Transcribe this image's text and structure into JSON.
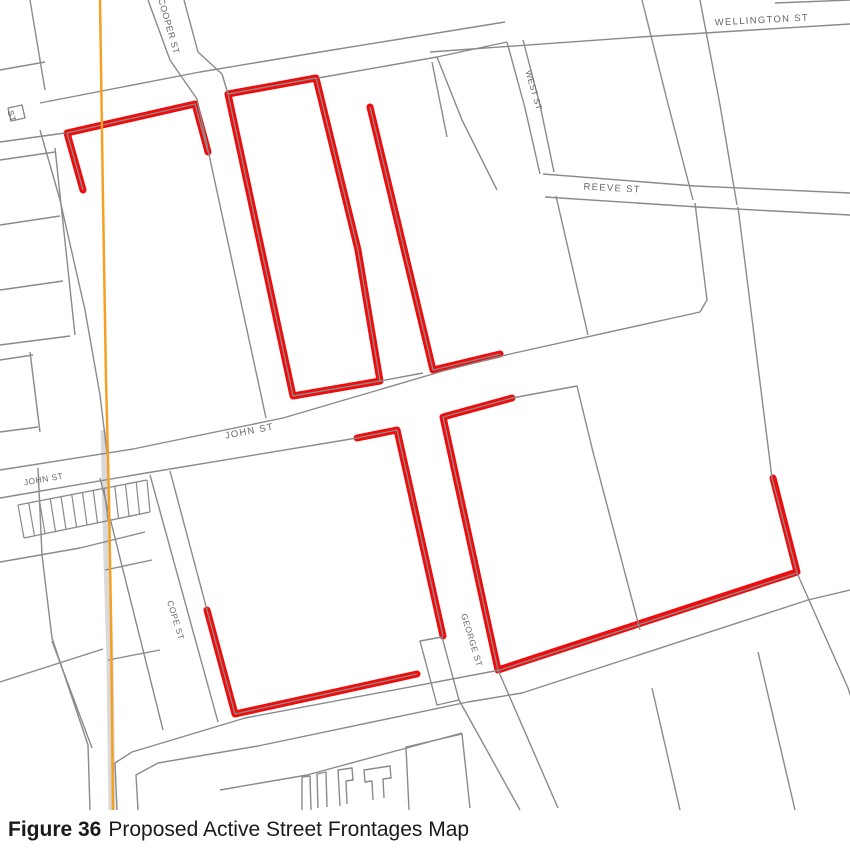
{
  "figure": {
    "label": "Figure 36",
    "title": "Proposed Active Street Frontages Map"
  },
  "map": {
    "colors": {
      "frontage": "#f00c0c",
      "road": "#8a8a8a",
      "rail": "#f5a023",
      "rail_band": "#d9d9d9",
      "label": "#666666"
    },
    "street_labels": [
      {
        "text": "COOPER ST",
        "x": 166,
        "y": 27,
        "angle": 74,
        "size": 9,
        "spacing": 0.5
      },
      {
        "text": "ST",
        "x": 9,
        "y": 117,
        "angle": 74,
        "size": 8.5,
        "spacing": 0.5
      },
      {
        "text": "WELLINGTON ST",
        "x": 762,
        "y": 23,
        "angle": -3,
        "size": 9.5,
        "spacing": 1.3
      },
      {
        "text": "WEST ST",
        "x": 531,
        "y": 91,
        "angle": 74,
        "size": 8.5,
        "spacing": 0.5
      },
      {
        "text": "REEVE ST",
        "x": 612,
        "y": 191,
        "angle": 3,
        "size": 9.5,
        "spacing": 1.3
      },
      {
        "text": "JOHN ST",
        "x": 250,
        "y": 434,
        "angle": -11,
        "size": 9.5,
        "spacing": 1.3
      },
      {
        "text": "JOHN ST",
        "x": 44,
        "y": 482,
        "angle": -10,
        "size": 8.5,
        "spacing": 0.5
      },
      {
        "text": "COPE ST",
        "x": 173,
        "y": 621,
        "angle": 73,
        "size": 8.5,
        "spacing": 0.5
      },
      {
        "text": "GEORGE ST",
        "x": 469,
        "y": 641,
        "angle": 73,
        "size": 8.5,
        "spacing": 0.5
      }
    ],
    "frontages": [
      {
        "pts": [
          [
            83,
            190
          ],
          [
            67,
            133
          ],
          [
            195,
            104
          ],
          [
            208,
            152
          ]
        ]
      },
      {
        "pts": [
          [
            228,
            94
          ],
          [
            316,
            78
          ],
          [
            358,
            250
          ],
          [
            380,
            381
          ],
          [
            293,
            396
          ]
        ],
        "closed": true
      },
      {
        "pts": [
          [
            370,
            107
          ],
          [
            433,
            370
          ],
          [
            500,
            354
          ]
        ]
      },
      {
        "pts": [
          [
            512,
            398
          ],
          [
            443,
            417
          ],
          [
            498,
            670
          ]
        ]
      },
      {
        "pts": [
          [
            357,
            438
          ],
          [
            397,
            430
          ],
          [
            443,
            636
          ]
        ]
      },
      {
        "pts": [
          [
            207,
            610
          ],
          [
            235,
            714
          ],
          [
            417,
            674
          ]
        ]
      },
      {
        "pts": [
          [
            498,
            670
          ],
          [
            797,
            572
          ],
          [
            773,
            478
          ]
        ]
      }
    ],
    "roads": [
      {
        "pts": [
          [
            40,
            103
          ],
          [
            200,
            72
          ],
          [
            320,
            52
          ],
          [
            505,
            22
          ]
        ]
      },
      {
        "pts": [
          [
            0,
            142
          ],
          [
            65,
            133
          ]
        ]
      },
      {
        "pts": [
          [
            318,
            78
          ],
          [
            437,
            57
          ],
          [
            507,
            42
          ]
        ]
      },
      {
        "pts": [
          [
            148,
            0
          ],
          [
            170,
            60
          ],
          [
            181,
            76
          ],
          [
            197,
            99
          ],
          [
            266,
            418
          ]
        ]
      },
      {
        "pts": [
          [
            184,
            0
          ],
          [
            198,
            52
          ]
        ]
      },
      {
        "pts": [
          [
            198,
            52
          ],
          [
            222,
            74
          ],
          [
            228,
            94
          ]
        ]
      },
      {
        "pts": [
          [
            0,
            470
          ],
          [
            133,
            449
          ],
          [
            283,
            418
          ],
          [
            443,
            371
          ],
          [
            510,
            354
          ],
          [
            700,
            312
          ],
          [
            707,
            300
          ],
          [
            695,
            203
          ]
        ]
      },
      {
        "pts": [
          [
            0,
            498
          ],
          [
            140,
            474
          ],
          [
            357,
            438
          ]
        ]
      },
      {
        "pts": [
          [
            512,
            398
          ],
          [
            577,
            386
          ],
          [
            593,
            452
          ],
          [
            640,
            630
          ]
        ]
      },
      {
        "pts": [
          [
            459,
            700
          ],
          [
            520,
            810
          ]
        ]
      },
      {
        "pts": [
          [
            498,
            670
          ],
          [
            558,
            808
          ]
        ]
      },
      {
        "pts": [
          [
            117,
            810
          ],
          [
            115,
            763
          ],
          [
            132,
            752
          ],
          [
            245,
            718
          ],
          [
            500,
            670
          ],
          [
            797,
            573
          ],
          [
            772,
            478
          ],
          [
            738,
            207
          ]
        ]
      },
      {
        "pts": [
          [
            797,
            573
          ],
          [
            848,
            688
          ],
          [
            852,
            700
          ]
        ]
      },
      {
        "pts": [
          [
            138,
            810
          ],
          [
            136,
            775
          ],
          [
            158,
            763
          ],
          [
            258,
            746
          ],
          [
            468,
            702
          ],
          [
            522,
            693
          ],
          [
            808,
            600
          ],
          [
            850,
            590
          ]
        ]
      },
      {
        "pts": [
          [
            220,
            790
          ],
          [
            307,
            775
          ],
          [
            462,
            733
          ]
        ]
      },
      {
        "pts": [
          [
            642,
            0
          ],
          [
            667,
            100
          ],
          [
            693,
            200
          ]
        ]
      },
      {
        "pts": [
          [
            700,
            0
          ],
          [
            720,
            105
          ],
          [
            737,
            205
          ]
        ]
      },
      {
        "pts": [
          [
            430,
            52
          ],
          [
            640,
            37
          ],
          [
            850,
            24
          ]
        ]
      },
      {
        "pts": [
          [
            775,
            3
          ],
          [
            850,
            0
          ]
        ]
      },
      {
        "pts": [
          [
            543,
            174
          ],
          [
            695,
            186
          ],
          [
            850,
            193
          ]
        ]
      },
      {
        "pts": [
          [
            545,
            197
          ],
          [
            698,
            207
          ],
          [
            850,
            215
          ]
        ]
      },
      {
        "pts": [
          [
            507,
            42
          ],
          [
            525,
            108
          ],
          [
            540,
            174
          ]
        ]
      },
      {
        "pts": [
          [
            523,
            40
          ],
          [
            540,
            105
          ],
          [
            554,
            172
          ]
        ]
      },
      {
        "pts": [
          [
            556,
            196
          ],
          [
            588,
            335
          ]
        ]
      },
      {
        "pts": [
          [
            437,
            57
          ],
          [
            462,
            120
          ],
          [
            497,
            190
          ]
        ]
      },
      {
        "pts": [
          [
            432,
            62
          ],
          [
            447,
            137
          ]
        ]
      },
      {
        "pts": [
          [
            40,
            130
          ],
          [
            60,
            200
          ],
          [
            85,
            310
          ],
          [
            100,
            395
          ],
          [
            107,
            453
          ]
        ]
      },
      {
        "pts": [
          [
            30,
            0
          ],
          [
            45,
            90
          ]
        ]
      },
      {
        "pts": [
          [
            0,
            70
          ],
          [
            45,
            62
          ]
        ]
      },
      {
        "pts": [
          [
            55,
            148
          ],
          [
            75,
            335
          ]
        ]
      },
      {
        "pts": [
          [
            0,
            160
          ],
          [
            55,
            152
          ]
        ]
      },
      {
        "pts": [
          [
            0,
            225
          ],
          [
            60,
            216
          ]
        ]
      },
      {
        "pts": [
          [
            0,
            290
          ],
          [
            63,
            281
          ]
        ]
      },
      {
        "pts": [
          [
            0,
            345
          ],
          [
            70,
            336
          ]
        ]
      },
      {
        "pts": [
          [
            30,
            352
          ],
          [
            40,
            432
          ]
        ]
      },
      {
        "pts": [
          [
            0,
            360
          ],
          [
            33,
            355
          ]
        ]
      },
      {
        "pts": [
          [
            0,
            432
          ],
          [
            38,
            427
          ]
        ]
      },
      {
        "pts": [
          [
            90,
            810
          ],
          [
            88,
            745
          ],
          [
            52,
            638
          ],
          [
            42,
            555
          ],
          [
            38,
            468
          ]
        ]
      },
      {
        "pts": [
          [
            0,
            682
          ],
          [
            103,
            649
          ]
        ]
      },
      {
        "pts": [
          [
            52,
            641
          ],
          [
            92,
            748
          ]
        ]
      },
      {
        "pts": [
          [
            0,
            562
          ],
          [
            80,
            548
          ],
          [
            145,
            532
          ]
        ]
      },
      {
        "pts": [
          [
            100,
            478
          ],
          [
            163,
            730
          ]
        ]
      },
      {
        "pts": [
          [
            105,
            570
          ],
          [
            152,
            560
          ]
        ]
      },
      {
        "pts": [
          [
            108,
            660
          ],
          [
            160,
            650
          ]
        ]
      },
      {
        "pts": [
          [
            150,
            475
          ],
          [
            218,
            722
          ]
        ]
      },
      {
        "pts": [
          [
            170,
            471
          ],
          [
            207,
            610
          ]
        ]
      },
      {
        "pts": [
          [
            420,
            641
          ],
          [
            442,
            637
          ],
          [
            459,
            700
          ],
          [
            437,
            705
          ]
        ],
        "closed": true
      },
      {
        "pts": [
          [
            652,
            688
          ],
          [
            680,
            810
          ]
        ]
      },
      {
        "pts": [
          [
            758,
            652
          ],
          [
            795,
            810
          ]
        ]
      },
      {
        "pts": [
          [
            8,
            108
          ],
          [
            22,
            105
          ],
          [
            25,
            118
          ],
          [
            11,
            121
          ]
        ],
        "closed": true
      },
      {
        "pts": [
          [
            228,
            94
          ],
          [
            316,
            78
          ],
          [
            358,
            250
          ],
          [
            380,
            381
          ],
          [
            293,
            396
          ]
        ],
        "closed": true
      },
      {
        "pts": [
          [
            83,
            190
          ],
          [
            67,
            133
          ],
          [
            195,
            104
          ],
          [
            208,
            152
          ]
        ]
      },
      {
        "pts": [
          [
            370,
            107
          ],
          [
            433,
            370
          ],
          [
            500,
            354
          ]
        ]
      },
      {
        "pts": [
          [
            512,
            398
          ],
          [
            443,
            417
          ],
          [
            498,
            670
          ]
        ]
      },
      {
        "pts": [
          [
            357,
            438
          ],
          [
            397,
            430
          ],
          [
            443,
            636
          ]
        ]
      },
      {
        "pts": [
          [
            207,
            610
          ],
          [
            235,
            714
          ],
          [
            417,
            674
          ]
        ]
      },
      {
        "pts": [
          [
            380,
            381
          ],
          [
            423,
            373
          ]
        ]
      },
      {
        "pts": [
          [
            302,
            810
          ],
          [
            302,
            777
          ],
          [
            310,
            776
          ],
          [
            311,
            810
          ]
        ]
      },
      {
        "pts": [
          [
            318,
            808
          ],
          [
            317,
            774
          ],
          [
            326,
            772
          ],
          [
            327,
            807
          ]
        ]
      },
      {
        "pts": [
          [
            340,
            806
          ],
          [
            338,
            770
          ],
          [
            352,
            768
          ],
          [
            353,
            780
          ],
          [
            346,
            781
          ],
          [
            347,
            804
          ]
        ]
      },
      {
        "pts": [
          [
            373,
            800
          ],
          [
            372,
            781
          ],
          [
            365,
            782
          ],
          [
            364,
            770
          ],
          [
            390,
            766
          ],
          [
            391,
            778
          ],
          [
            383,
            779
          ],
          [
            384,
            798
          ]
        ]
      },
      {
        "pts": [
          [
            409,
            810
          ],
          [
            406,
            747
          ],
          [
            462,
            734
          ],
          [
            470,
            808
          ]
        ]
      }
    ],
    "hatch": {
      "top": [
        [
          18,
          505
        ],
        [
          147,
          480
        ]
      ],
      "bottom": [
        [
          24,
          538
        ],
        [
          150,
          512
        ]
      ],
      "count": 13
    },
    "rail_band": {
      "pts": [
        [
          104,
          430
        ],
        [
          107,
          560
        ],
        [
          110,
          660
        ],
        [
          112,
          810
        ]
      ],
      "width": 7
    },
    "rail_line": {
      "pts": [
        [
          100,
          0
        ],
        [
          103,
          200
        ],
        [
          106,
          380
        ],
        [
          109,
          500
        ],
        [
          111,
          620
        ],
        [
          113,
          810
        ]
      ],
      "width": 2.5
    }
  }
}
